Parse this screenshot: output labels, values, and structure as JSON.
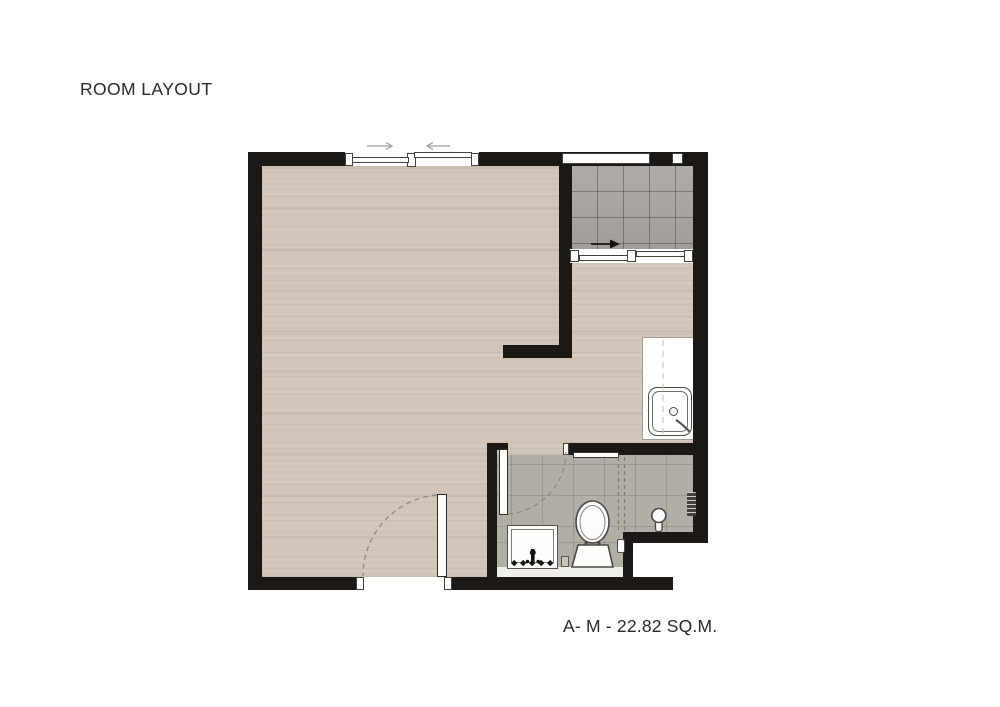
{
  "page": {
    "background": "#ffffff",
    "width": 1000,
    "height": 707
  },
  "header": {
    "title": "ROOM LAYOUT"
  },
  "footer": {
    "area_label": "A- M - 22.82 SQ.M."
  },
  "palette": {
    "wall": "#1c1815",
    "wood_floor": "#d1c6b9",
    "balcony_tile": "#a9a5a2",
    "bathroom_tile": "#b1ada7",
    "fixture_fill": "#ffffff",
    "fixture_outline": "#4d4843",
    "text": "#2b2829"
  },
  "plan_symbols": [
    {
      "name": "sliding-window-icon",
      "location": "top wall of main room"
    },
    {
      "name": "slide-direction-arrow-icons",
      "location": "above top sliding window"
    },
    {
      "name": "window-icon",
      "location": "top wall of balcony"
    },
    {
      "name": "entry-direction-arrow-icon",
      "location": "balcony tiles"
    },
    {
      "name": "sliding-door-icon",
      "location": "between balcony and room"
    },
    {
      "name": "kitchen-counter-sink-icon",
      "location": "right wall"
    },
    {
      "name": "bathroom-door-swing-icon",
      "location": "bathroom entry"
    },
    {
      "name": "vanity-sink-icon",
      "location": "bathroom"
    },
    {
      "name": "toilet-icon",
      "location": "bathroom"
    },
    {
      "name": "shower-head-icon",
      "location": "bathroom"
    },
    {
      "name": "shower-mixer-icon",
      "location": "bathroom right wall"
    },
    {
      "name": "towel-bar-icon",
      "location": "bathroom top wall"
    },
    {
      "name": "entrance-door-swing-icon",
      "location": "bottom wall"
    }
  ]
}
